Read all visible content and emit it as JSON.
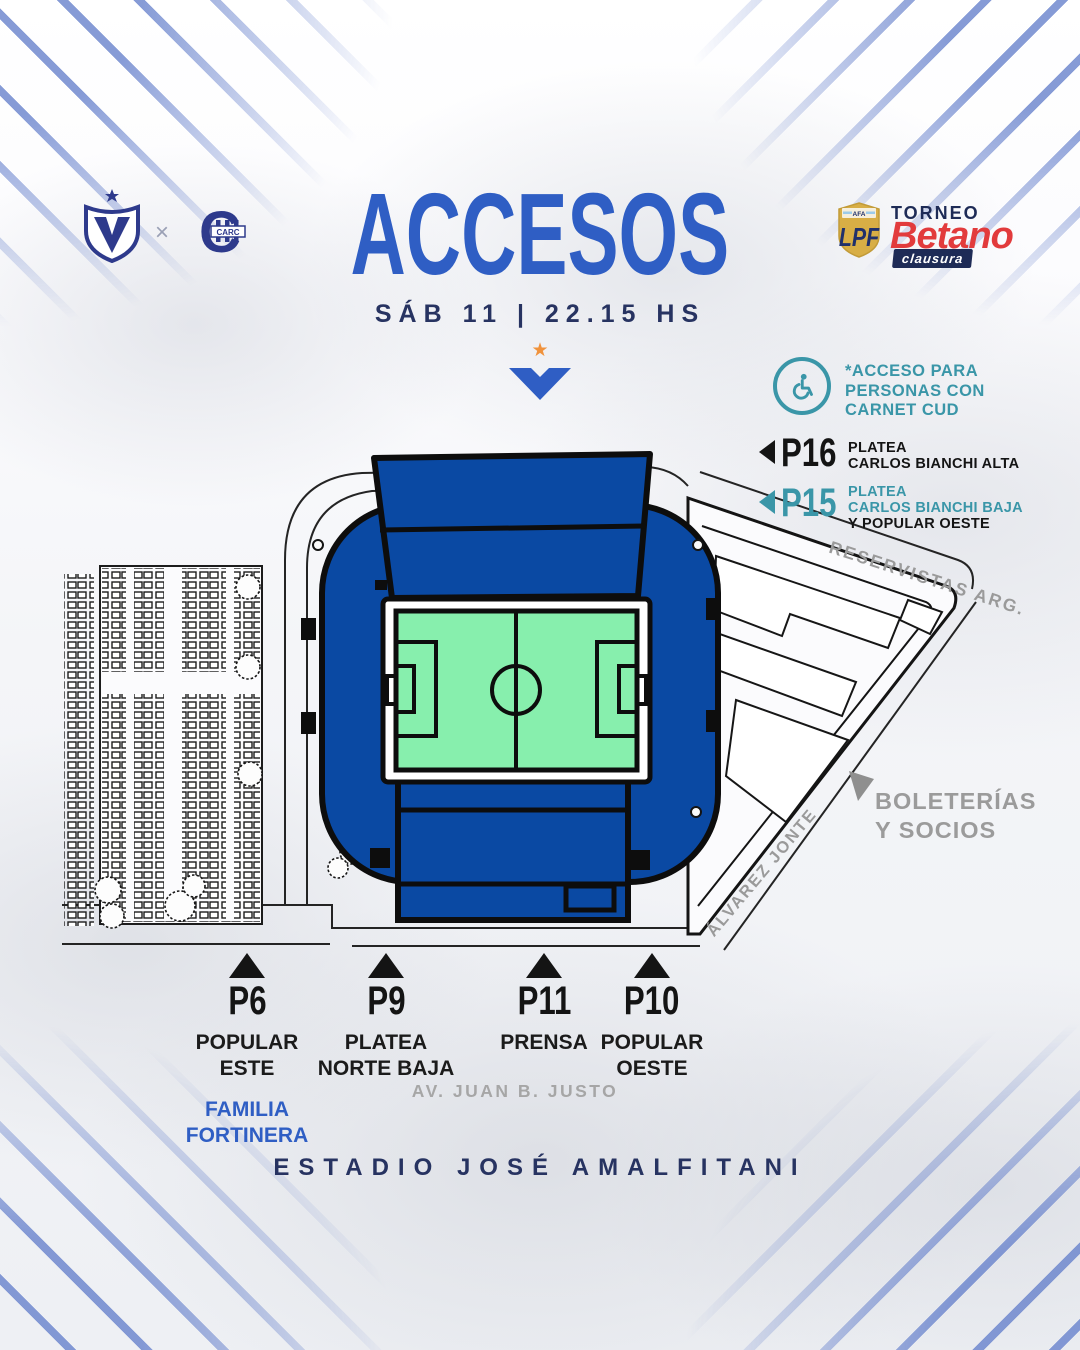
{
  "poster": {
    "title": "ACCESOS",
    "datetime": "SÁB 11 | 22.15 HS",
    "footer": "ESTADIO JOSÉ AMALFITANI",
    "separator": "×"
  },
  "icons": {
    "star": "★"
  },
  "crests": {
    "home": "velez-sarsfield-crest",
    "away": "rosario-central-crest",
    "central_letter": "C",
    "central_text": "CARC"
  },
  "tournament": {
    "afa": "AFA",
    "lpf": "LPF",
    "torneo": "TORNEO",
    "sponsor": "Betano",
    "stage": "clausura"
  },
  "legend": {
    "cud": {
      "line1": "*ACCESO PARA",
      "line2": "PERSONAS CON",
      "line3": "CARNET CUD"
    },
    "p16": {
      "id": "P16",
      "line1": "PLATEA",
      "line2": "CARLOS BIANCHI ALTA"
    },
    "p15": {
      "id": "P15",
      "line1": "PLATEA",
      "line2": "CARLOS BIANCHI BAJA",
      "line3": "Y POPULAR OESTE"
    }
  },
  "map": {
    "street_reservistas": "RESERVISTAS ARG.",
    "street_alvarez": "ÁLVAREZ JONTE",
    "street_juanbjusto": "AV. JUAN B. JUSTO",
    "boleterias_line1": "BOLETERÍAS",
    "boleterias_line2": "Y SOCIOS"
  },
  "gates": {
    "p6": {
      "id": "P6",
      "line1": "POPULAR",
      "line2": "ESTE",
      "extra1": "FAMILIA",
      "extra2": "FORTINERA"
    },
    "p9": {
      "id": "P9",
      "line1": "PLATEA",
      "line2": "NORTE BAJA"
    },
    "p11": {
      "id": "P11",
      "line1": "PRENSA"
    },
    "p10": {
      "id": "P10",
      "line1": "POPULAR",
      "line2": "OESTE"
    }
  },
  "colors": {
    "accent_blue": "#2f5ec4",
    "navy": "#273361",
    "teal": "#3a96a8",
    "stadium_blue": "#0a49a3",
    "pitch_green": "#87efad",
    "betano_red": "#e23b3c",
    "lpf_gold": "#d8ae45",
    "street_gray": "#9a9a9a",
    "orange_star": "#f0923c"
  }
}
